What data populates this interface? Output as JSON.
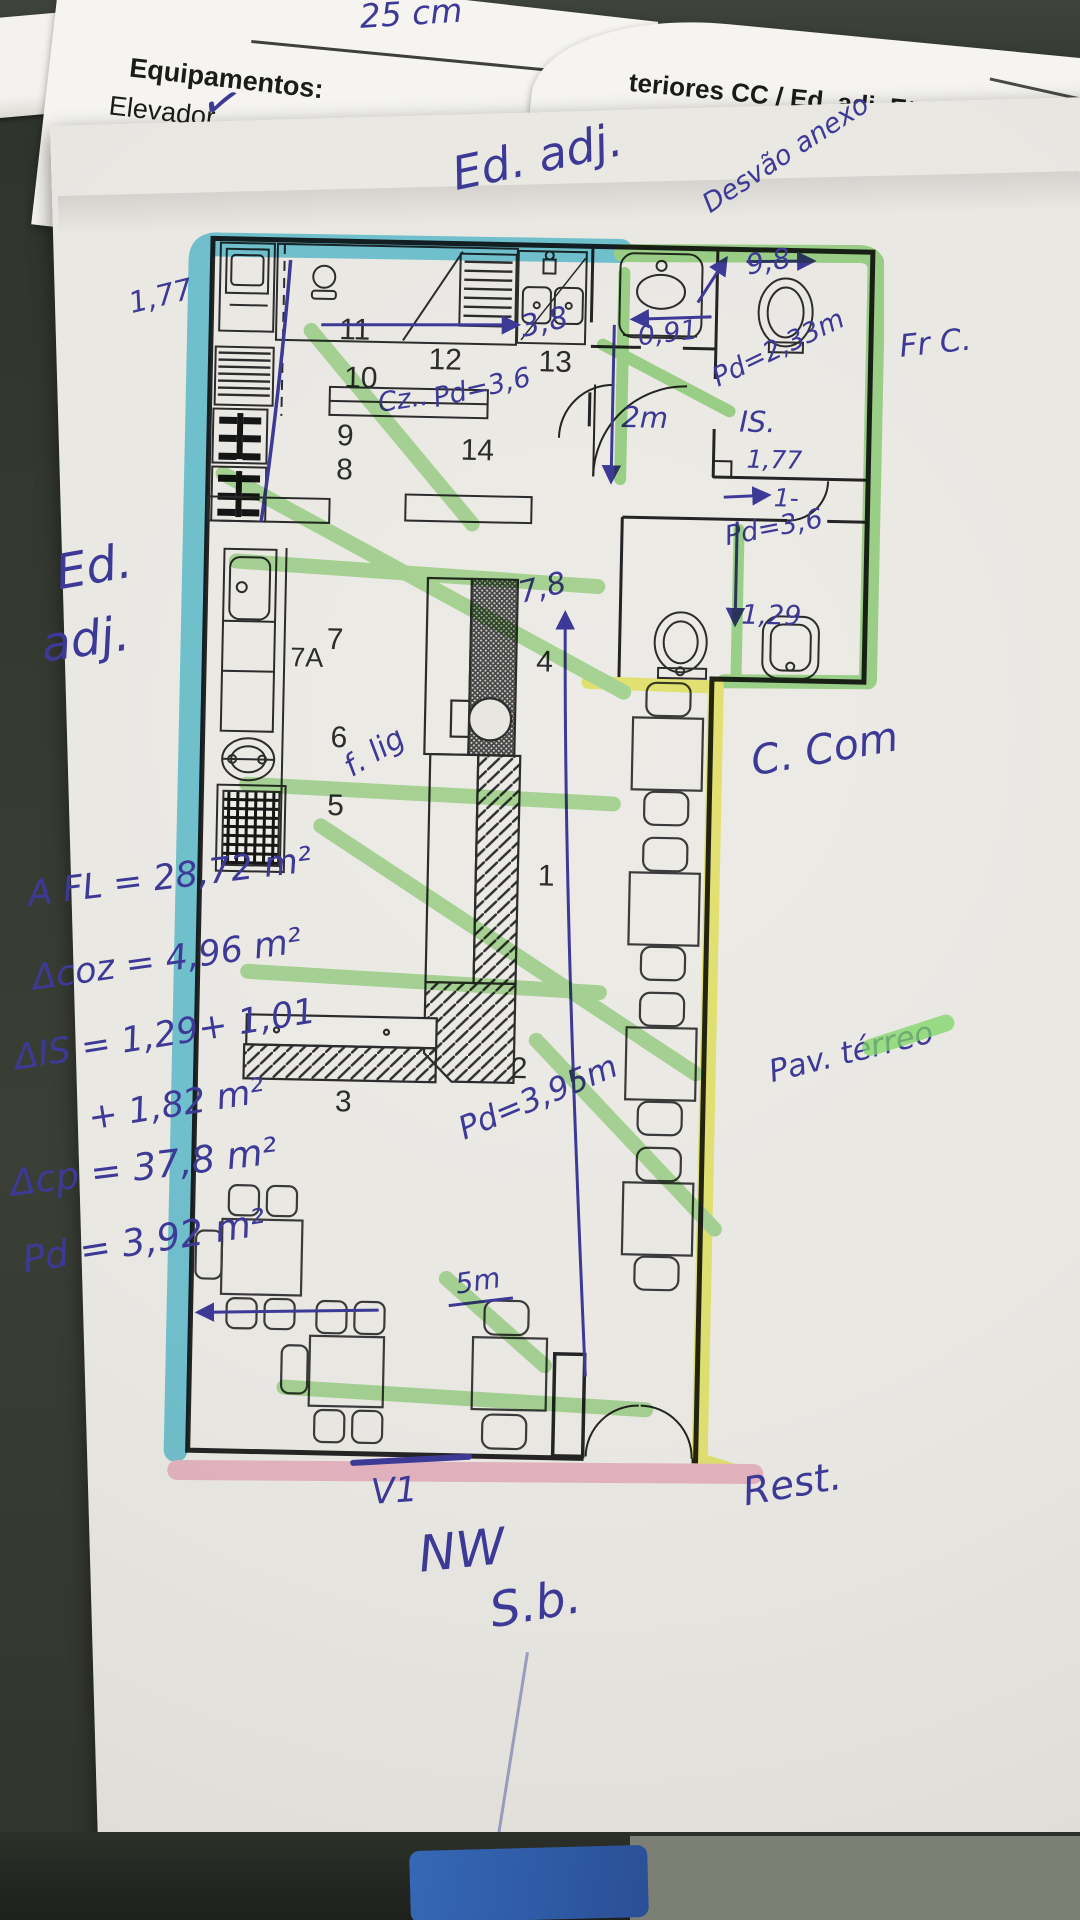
{
  "colors": {
    "highlight_cyan": "#3bbcd9",
    "highlight_green": "#8fd878",
    "highlight_yellow": "#eef041",
    "highlight_pink": "#f4a9c3",
    "pen_blue": "#3c3a96",
    "paper": "#e9e7e2"
  },
  "sheet_left": {
    "measure_note": "25 cm",
    "header": "Equipamentos:",
    "item1": "Elevador",
    "check": "✓",
    "item2": "Rede de C"
  },
  "sheet_right": {
    "header": "teriores CC / Ed. adj. Etc.:",
    "field_label": "ra:",
    "field_value": "15cm"
  },
  "annotations": {
    "top_ed_adj": "Ed. adj.",
    "desvao": "Desvão anexo",
    "dim_9_8": "9,8",
    "left_dim_1_77": "1,77",
    "left_ed": "Ed.",
    "left_adj": "adj.",
    "area_fl": "A FL = 28,72 m²",
    "area_coz": "Δcoz = 4,96 m²",
    "area_is_1": "ΔIS = 1,29+ 1,01",
    "area_is_2": "+ 1,82 m²",
    "area_cp": "Δcp =  37,8 m²",
    "pd_total": "Pd = 3,92 m²",
    "fr_c": "Fr C.",
    "c_com": "C. Com",
    "pav_terreo": "Pav. térreo",
    "rest": "Rest.",
    "v1": "V1",
    "nw": "NW",
    "sb": "S.b."
  },
  "plan": {
    "labels": {
      "n1": "1",
      "n2": "2",
      "n3": "3",
      "n4": "4",
      "n5": "5",
      "n6": "6",
      "n7": "7",
      "n7a": "7A",
      "n8": "8",
      "n9": "9",
      "n10": "10",
      "n11": "11",
      "n12": "12",
      "n13": "13",
      "n14": "14"
    },
    "dims": {
      "d38": "3,8",
      "cz": "Cz..",
      "pd36a": "Pd=3,6",
      "d091": "0,91",
      "d2m": "2m",
      "pd233": "Pd=2,33m",
      "is_room": "IS.",
      "d177": "1,77",
      "one": "1-",
      "pd36b": "Pd=3,6",
      "d129": "1,29",
      "d78": "7,8",
      "flig": "f. lig",
      "pd395": "Pd=3,95m",
      "d5m": "5m"
    }
  }
}
